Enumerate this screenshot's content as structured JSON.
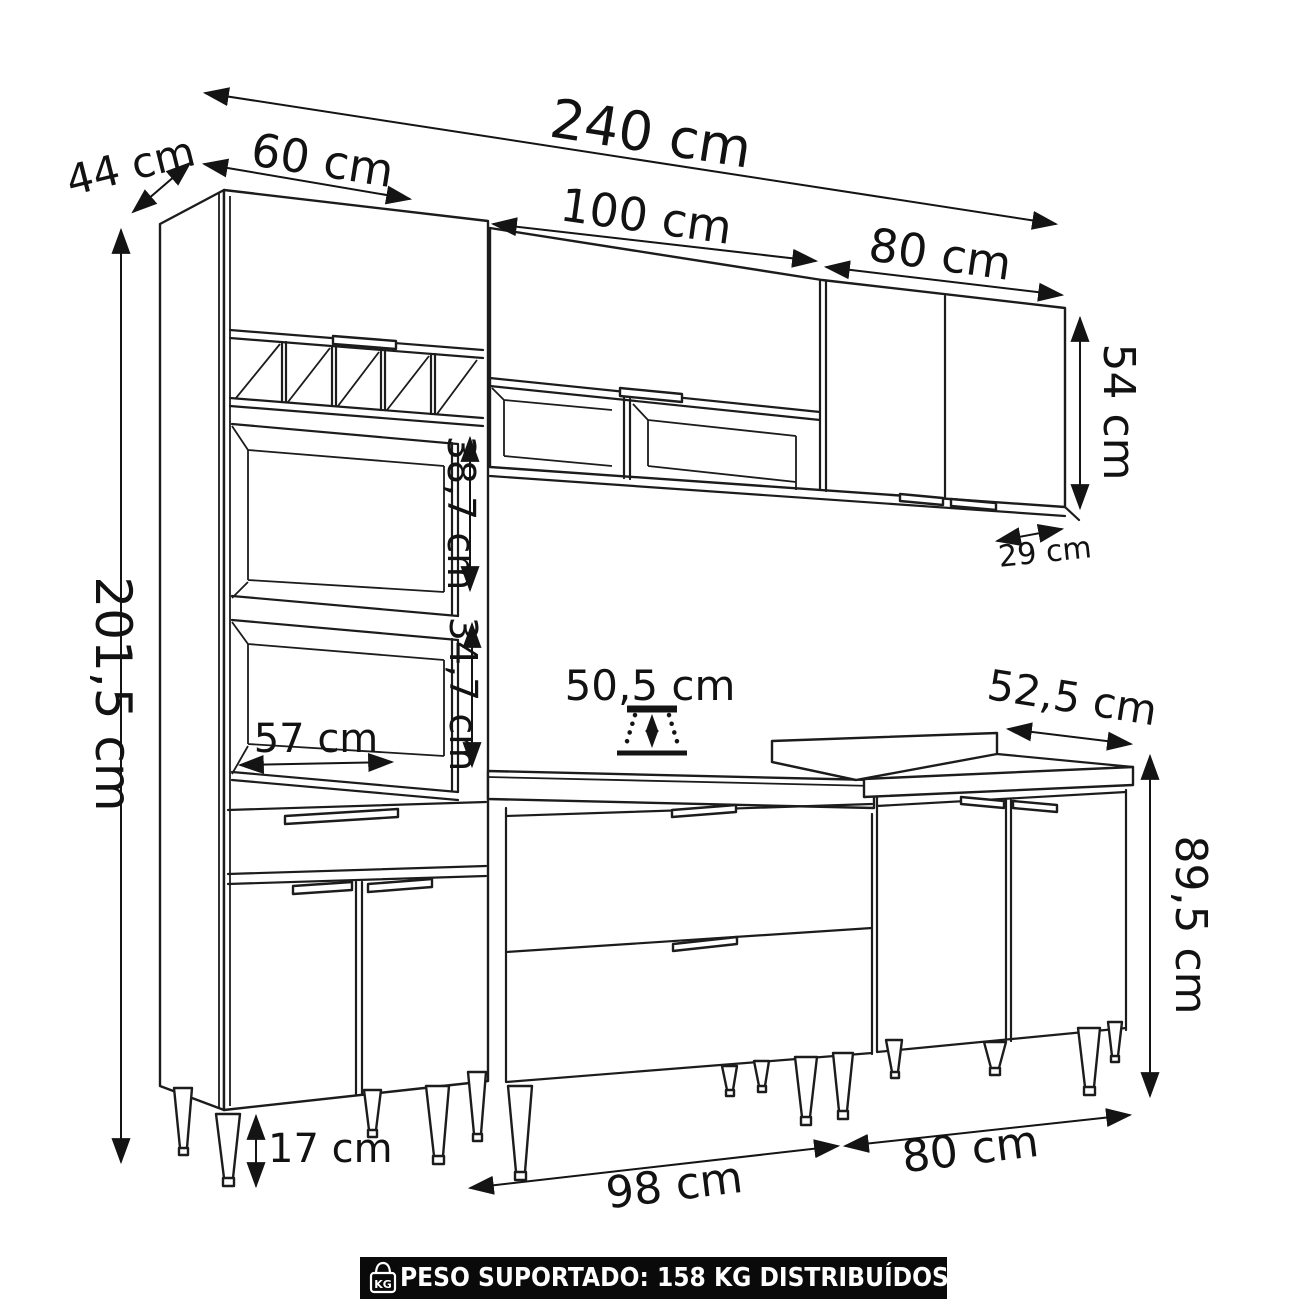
{
  "diagram": {
    "type": "furniture-dimension-drawing",
    "subject": "modular kitchen cabinet set (isometric line drawing)",
    "labels": {
      "total_width": "240 cm",
      "tall_depth": "44 cm",
      "tall_width": "60 cm",
      "wall_left_width": "100 cm",
      "wall_right_width": "80 cm",
      "wall_height": "54 cm",
      "wall_depth": "29 cm",
      "total_height": "201,5 cm",
      "niche_upper_height": "38,7 cm",
      "niche_lower_height": "34,7 cm",
      "niche_width": "57 cm",
      "mid_counter_depth": "50,5 cm",
      "right_counter_depth": "52,5 cm",
      "base_height": "89,5 cm",
      "legs_height": "17 cm",
      "base_mid_width": "98 cm",
      "base_right_width": "80 cm"
    },
    "footer": {
      "icon": "kg-weight-icon",
      "icon_text": "KG",
      "text": "PESO SUPORTADO: 158 KG DISTRIBUÍDOS",
      "bar_color": "#0a0a0a",
      "text_color": "#ffffff"
    },
    "line_color": "#1c1c1c",
    "background": "#ffffff"
  }
}
